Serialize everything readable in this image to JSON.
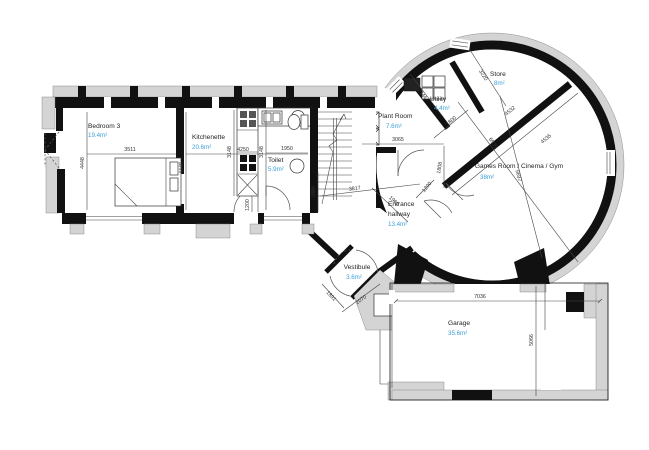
{
  "drawing": {
    "type": "floor-plan"
  },
  "colors": {
    "wall": "#111111",
    "existing_structure": "#d4d4d4",
    "area_text": "#3b9fd8",
    "label_text": "#1f1f1f",
    "dim_text": "#333333",
    "background": "#ffffff"
  },
  "rooms": [
    {
      "name": "Bedroom 3",
      "area": "19.4m²"
    },
    {
      "name": "Kitchenette",
      "area": "20.6m²"
    },
    {
      "name": "Toilet",
      "area": "5.9m²"
    },
    {
      "name": "Plant Room",
      "area": "7.6m²"
    },
    {
      "name": "Utility",
      "area": "4.4m²"
    },
    {
      "name": "Store",
      "area": "8m²"
    },
    {
      "name": "Games Room / Cinema / Gym",
      "area": "38m²"
    },
    {
      "name_line1": "Entrance",
      "name_line2": "hallway",
      "area": "13.4m²"
    },
    {
      "name": "Vestibule",
      "area": "3.6m²"
    },
    {
      "name": "Garage",
      "area": "35.6m²"
    }
  ],
  "dims": {
    "bedroom_width": "3511",
    "bedroom_depth": "4448",
    "kitchenette_width": "4250",
    "kitchenette_depth": "4448",
    "units_run_left": "3148",
    "units_run_right": "3148",
    "toilet_width": "1950",
    "units_recess": "1200",
    "stair_hall": "1884",
    "hallway_length": "3817",
    "hallway_diag": "1962",
    "plant_width": "3065",
    "plant_depth": "1808",
    "utility_depth": "2344",
    "utility_width": "1800",
    "store_depth": "3220",
    "chord_upper": "4532",
    "chord_lower": "4535",
    "games_diag_long": "6535",
    "games_diag_short": "5697",
    "entrance_door": "1200",
    "vestibule_side_a": "1891",
    "vestibule_side_b": "2070",
    "garage_width": "7036",
    "garage_depth": "5066"
  }
}
